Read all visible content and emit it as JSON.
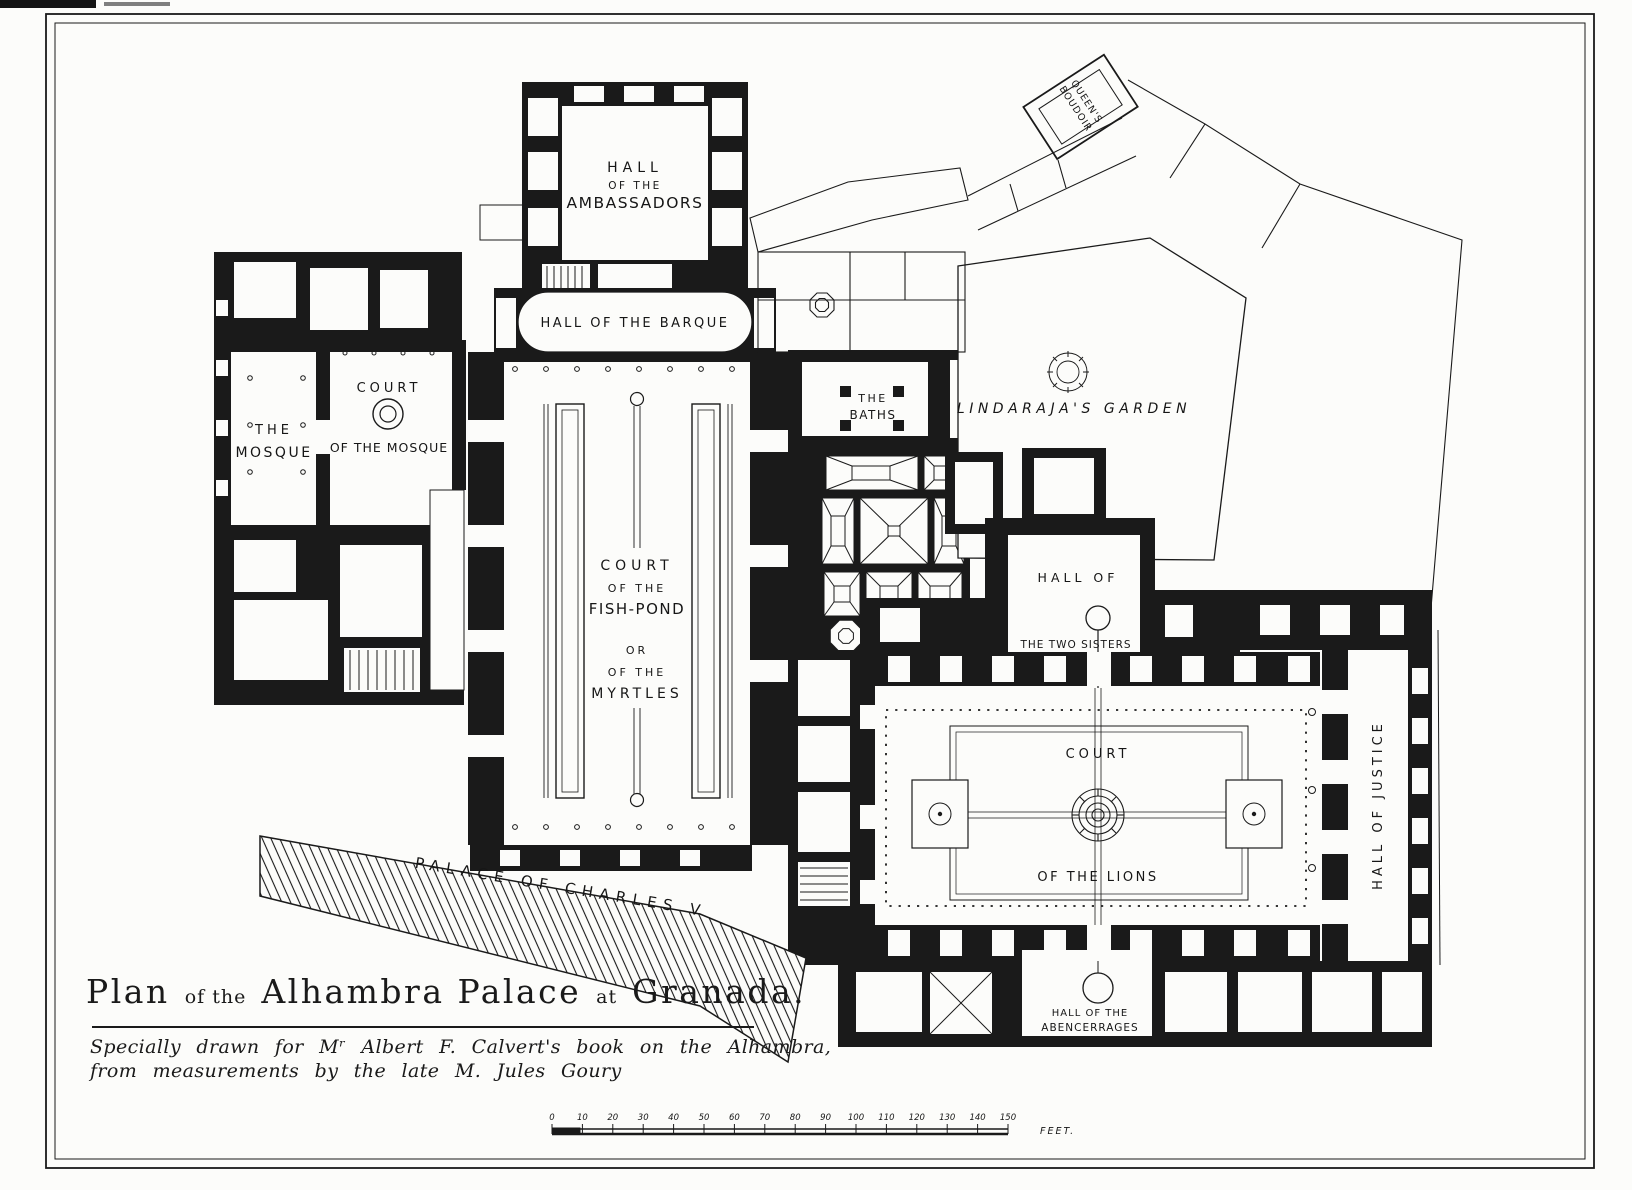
{
  "artwork": {
    "title_parts": [
      {
        "text": "Plan"
      },
      {
        "text": "of the"
      },
      {
        "text": "Alhambra Palace"
      },
      {
        "text": "at"
      },
      {
        "text": "Granada."
      }
    ],
    "credit_line1": "Specially drawn for Mʳ Albert F. Calvert's book on the Alhambra,",
    "credit_line2": "from measurements by the late M. Jules Goury"
  },
  "rooms": {
    "ambassadors": {
      "l1": "HALL",
      "l2": "OF THE",
      "l3": "AMBASSADORS"
    },
    "barque": {
      "l1": "HALL OF THE BARQUE"
    },
    "fishpond": {
      "l1": "COURT",
      "l2": "OF THE",
      "l3": "FISH-POND",
      "l4": "OR",
      "l5": "OF THE",
      "l6": "MYRTLES"
    },
    "mosque": {
      "l1": "THE",
      "l2": "MOSQUE"
    },
    "court_mosque": {
      "l1": "COURT",
      "l2": "OF THE MOSQUE"
    },
    "baths": {
      "l1": "THE",
      "l2": "BATHS"
    },
    "lindaraja": {
      "l1": "LINDARAJA'S  GARDEN"
    },
    "two_sisters": {
      "l1": "HALL OF",
      "l2": "THE TWO SISTERS"
    },
    "lions": {
      "l1": "COURT",
      "l2": "OF THE LIONS"
    },
    "justice": {
      "l1": "HALL OF JUSTICE"
    },
    "abencerrages": {
      "l1": "HALL OF THE",
      "l2": "ABENCERRAGES"
    },
    "boudoir": {
      "l1": "QUEEN'S",
      "l2": "BOUDOIR"
    },
    "charles_v": {
      "l1": "PALACE OF CHARLES V"
    }
  },
  "scale_bar": {
    "ticks": [
      "0",
      "10",
      "20",
      "30",
      "40",
      "50",
      "60",
      "70",
      "80",
      "90",
      "100",
      "110",
      "120",
      "130",
      "140",
      "150"
    ],
    "unit": "FEET."
  },
  "colors": {
    "ink": "#1a1a1a",
    "paper": "#fcfcfa"
  }
}
